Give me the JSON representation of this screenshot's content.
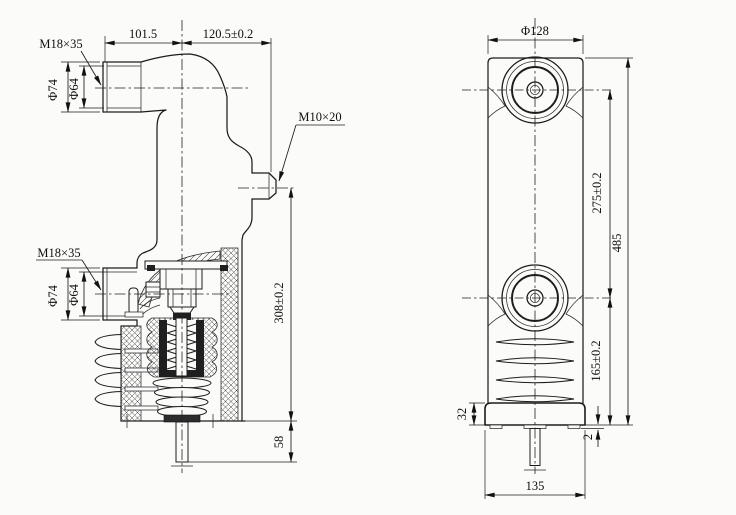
{
  "left_view": {
    "thread_label_upper": "M18×35",
    "thread_label_lower": "M18×35",
    "stud_label": "M10×20",
    "dim_width_left": "101.5",
    "dim_width_right": "120.5±0.2",
    "dim_dia_outer_upper": "Φ74",
    "dim_dia_inner_upper": "Φ64",
    "dim_dia_outer_lower": "Φ74",
    "dim_dia_inner_lower": "Φ64",
    "dim_height_main": "308±0.2",
    "dim_stem_length": "58"
  },
  "right_view": {
    "dim_dia_top": "Φ128",
    "dim_centers_span": "275±0.2",
    "dim_lower_center_to_base": "165±0.2",
    "dim_total_height": "485",
    "dim_flange_height": "32",
    "dim_foot_height": "2",
    "dim_flange_width": "135"
  }
}
